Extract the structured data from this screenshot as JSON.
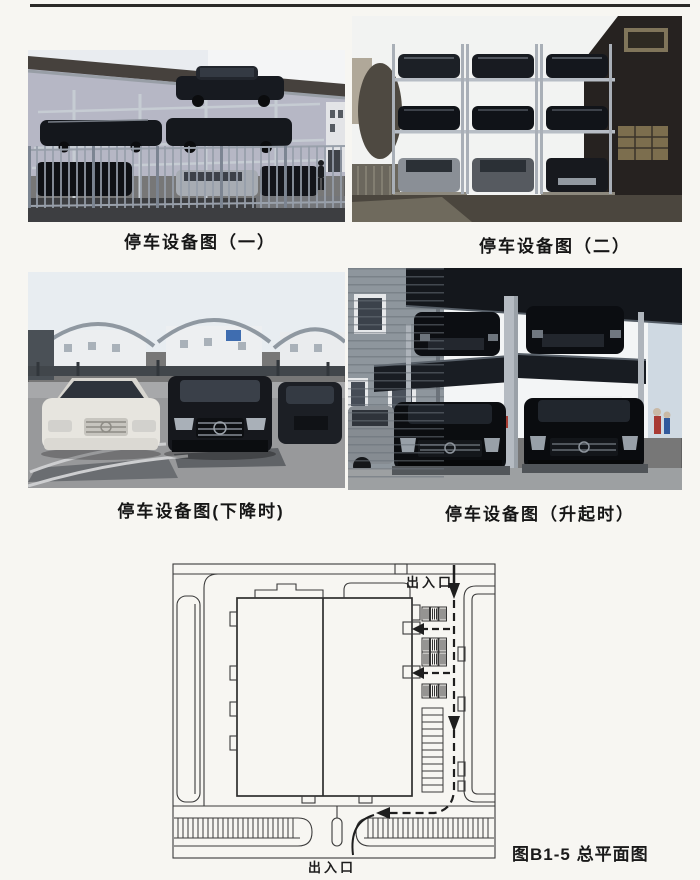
{
  "page": {
    "paper_color": "#f7f6f2",
    "ink_color": "#2b2a28"
  },
  "figures": {
    "photo_1": {
      "caption": "停车设备图（一）"
    },
    "photo_2": {
      "caption": "停车设备图（二）"
    },
    "photo_3": {
      "caption": "停车设备图(下降时)"
    },
    "photo_4": {
      "caption": "停车设备图（升起时）"
    }
  },
  "site_plan": {
    "caption": "图B1-5 总平面图",
    "entrance_top_label": "出入口",
    "entrance_bottom_label": "出入口"
  }
}
